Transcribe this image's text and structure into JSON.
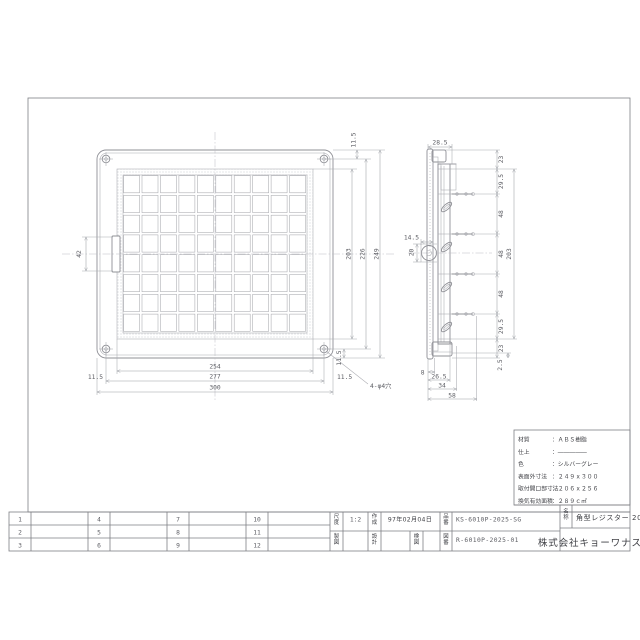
{
  "title_block": {
    "revision_numbers": [
      "1",
      "2",
      "3",
      "4",
      "5",
      "6",
      "7",
      "8",
      "9",
      "10",
      "11",
      "12"
    ],
    "scale_label": "尺度",
    "scale_value": "1:2",
    "created_label": "作成",
    "created_value": "97年02月04日",
    "part_label": "品番",
    "part_value": "KS-6010P-2025-SG",
    "draft_label": "製図",
    "design_label": "設計",
    "check_label": "検図",
    "dwgno_label": "図番",
    "dwgno_value": "R-6010P-2025-01",
    "name_label": "名称",
    "name_value": "角型レジスター 200x250",
    "company": "株式会社キョーワナスタ"
  },
  "spec_box": {
    "rows": [
      {
        "label": "材質",
        "value": "：ＡＢＳ樹脂"
      },
      {
        "label": "仕上",
        "value": "：―――――"
      },
      {
        "label": "色",
        "value": "：シルバーグレー"
      },
      {
        "label": "表面外寸法",
        "value": "：２４９ｘ３００"
      },
      {
        "label": "取付開口部寸法",
        "value": "：２０６ｘ２５６"
      },
      {
        "label": "換気有効面積",
        "value": "：２８９ｃ㎡"
      }
    ]
  },
  "dims": {
    "front_widths": [
      "254",
      "277",
      "300"
    ],
    "front_heights": [
      "203",
      "226",
      "249"
    ],
    "edge_offset": "11.5",
    "notch_height": "42",
    "holes_note": "4-φ4穴",
    "side_top_width": "28.5",
    "side_pitch_chain": [
      "23",
      "29.5",
      "48",
      "48",
      "48",
      "29.5",
      "23"
    ],
    "side_inner_height": "203",
    "side_lip": "2.5",
    "latch_depth": "14.5",
    "latch_height": "20",
    "side_bottom_chain": [
      "8",
      "26.5",
      "34",
      "58"
    ]
  },
  "front_view": {
    "grid_cols": 10,
    "grid_rows": 8
  }
}
